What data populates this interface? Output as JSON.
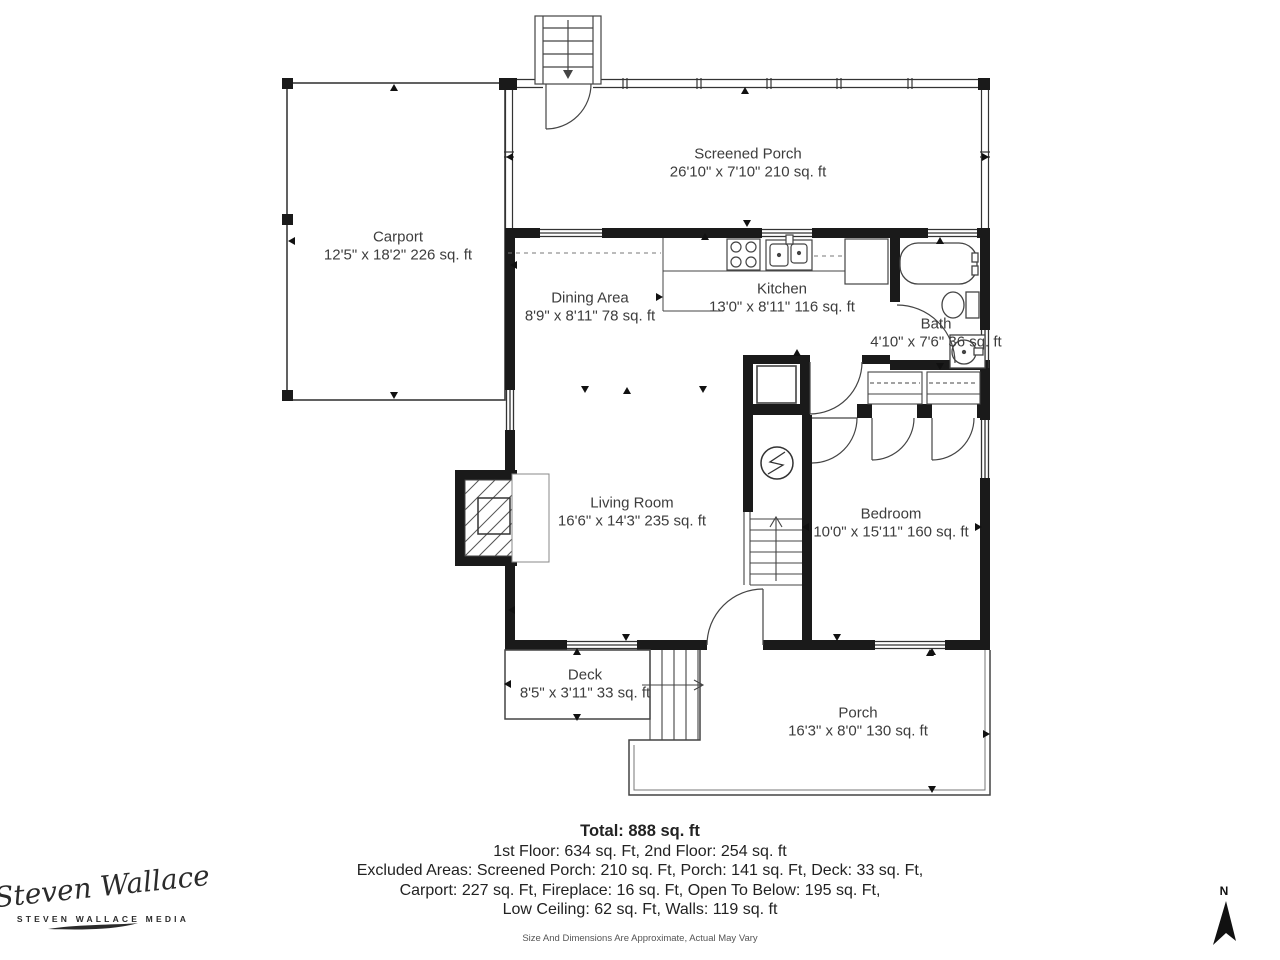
{
  "rooms": [
    {
      "name": "Screened Porch",
      "dims": "26'10\" x 7'10\" 210 sq. ft"
    },
    {
      "name": "Carport",
      "dims": "12'5\" x 18'2\" 226 sq. ft"
    },
    {
      "name": "Dining Area",
      "dims": "8'9\" x 8'11\" 78 sq. ft"
    },
    {
      "name": "Kitchen",
      "dims": "13'0\" x 8'11\" 116 sq. ft"
    },
    {
      "name": "Bath",
      "dims": "4'10\" x 7'6\" 36 sq. ft"
    },
    {
      "name": "Living Room",
      "dims": "16'6\" x 14'3\" 235 sq. ft"
    },
    {
      "name": "Bedroom",
      "dims": "10'0\" x 15'11\" 160 sq. ft"
    },
    {
      "name": "Deck",
      "dims": "8'5\" x 3'11\" 33 sq. ft"
    },
    {
      "name": "Porch",
      "dims": "16'3\" x 8'0\" 130 sq. ft"
    }
  ],
  "summary": {
    "total": "Total: 888 sq. ft",
    "lines": [
      "1st Floor: 634 sq. Ft, 2nd Floor: 254 sq. ft",
      "Excluded Areas: Screened Porch: 210 sq. Ft, Porch: 141 sq. Ft, Deck: 33 sq. Ft,",
      "Carport: 227 sq. Ft, Fireplace: 16 sq. Ft, Open To Below: 195 sq. Ft,",
      "Low Ceiling: 62 sq. Ft, Walls: 119 sq. ft"
    ],
    "disclaimer": "Size And Dimensions Are Approximate, Actual May Vary"
  },
  "branding": {
    "logo_script": "Steven Wallace",
    "logo_sub": "STEVEN WALLACE MEDIA"
  },
  "compass": {
    "label": "N"
  },
  "colors": {
    "wall": "#1a1a1a",
    "line": "#444444",
    "text": "#3d3d3d"
  }
}
